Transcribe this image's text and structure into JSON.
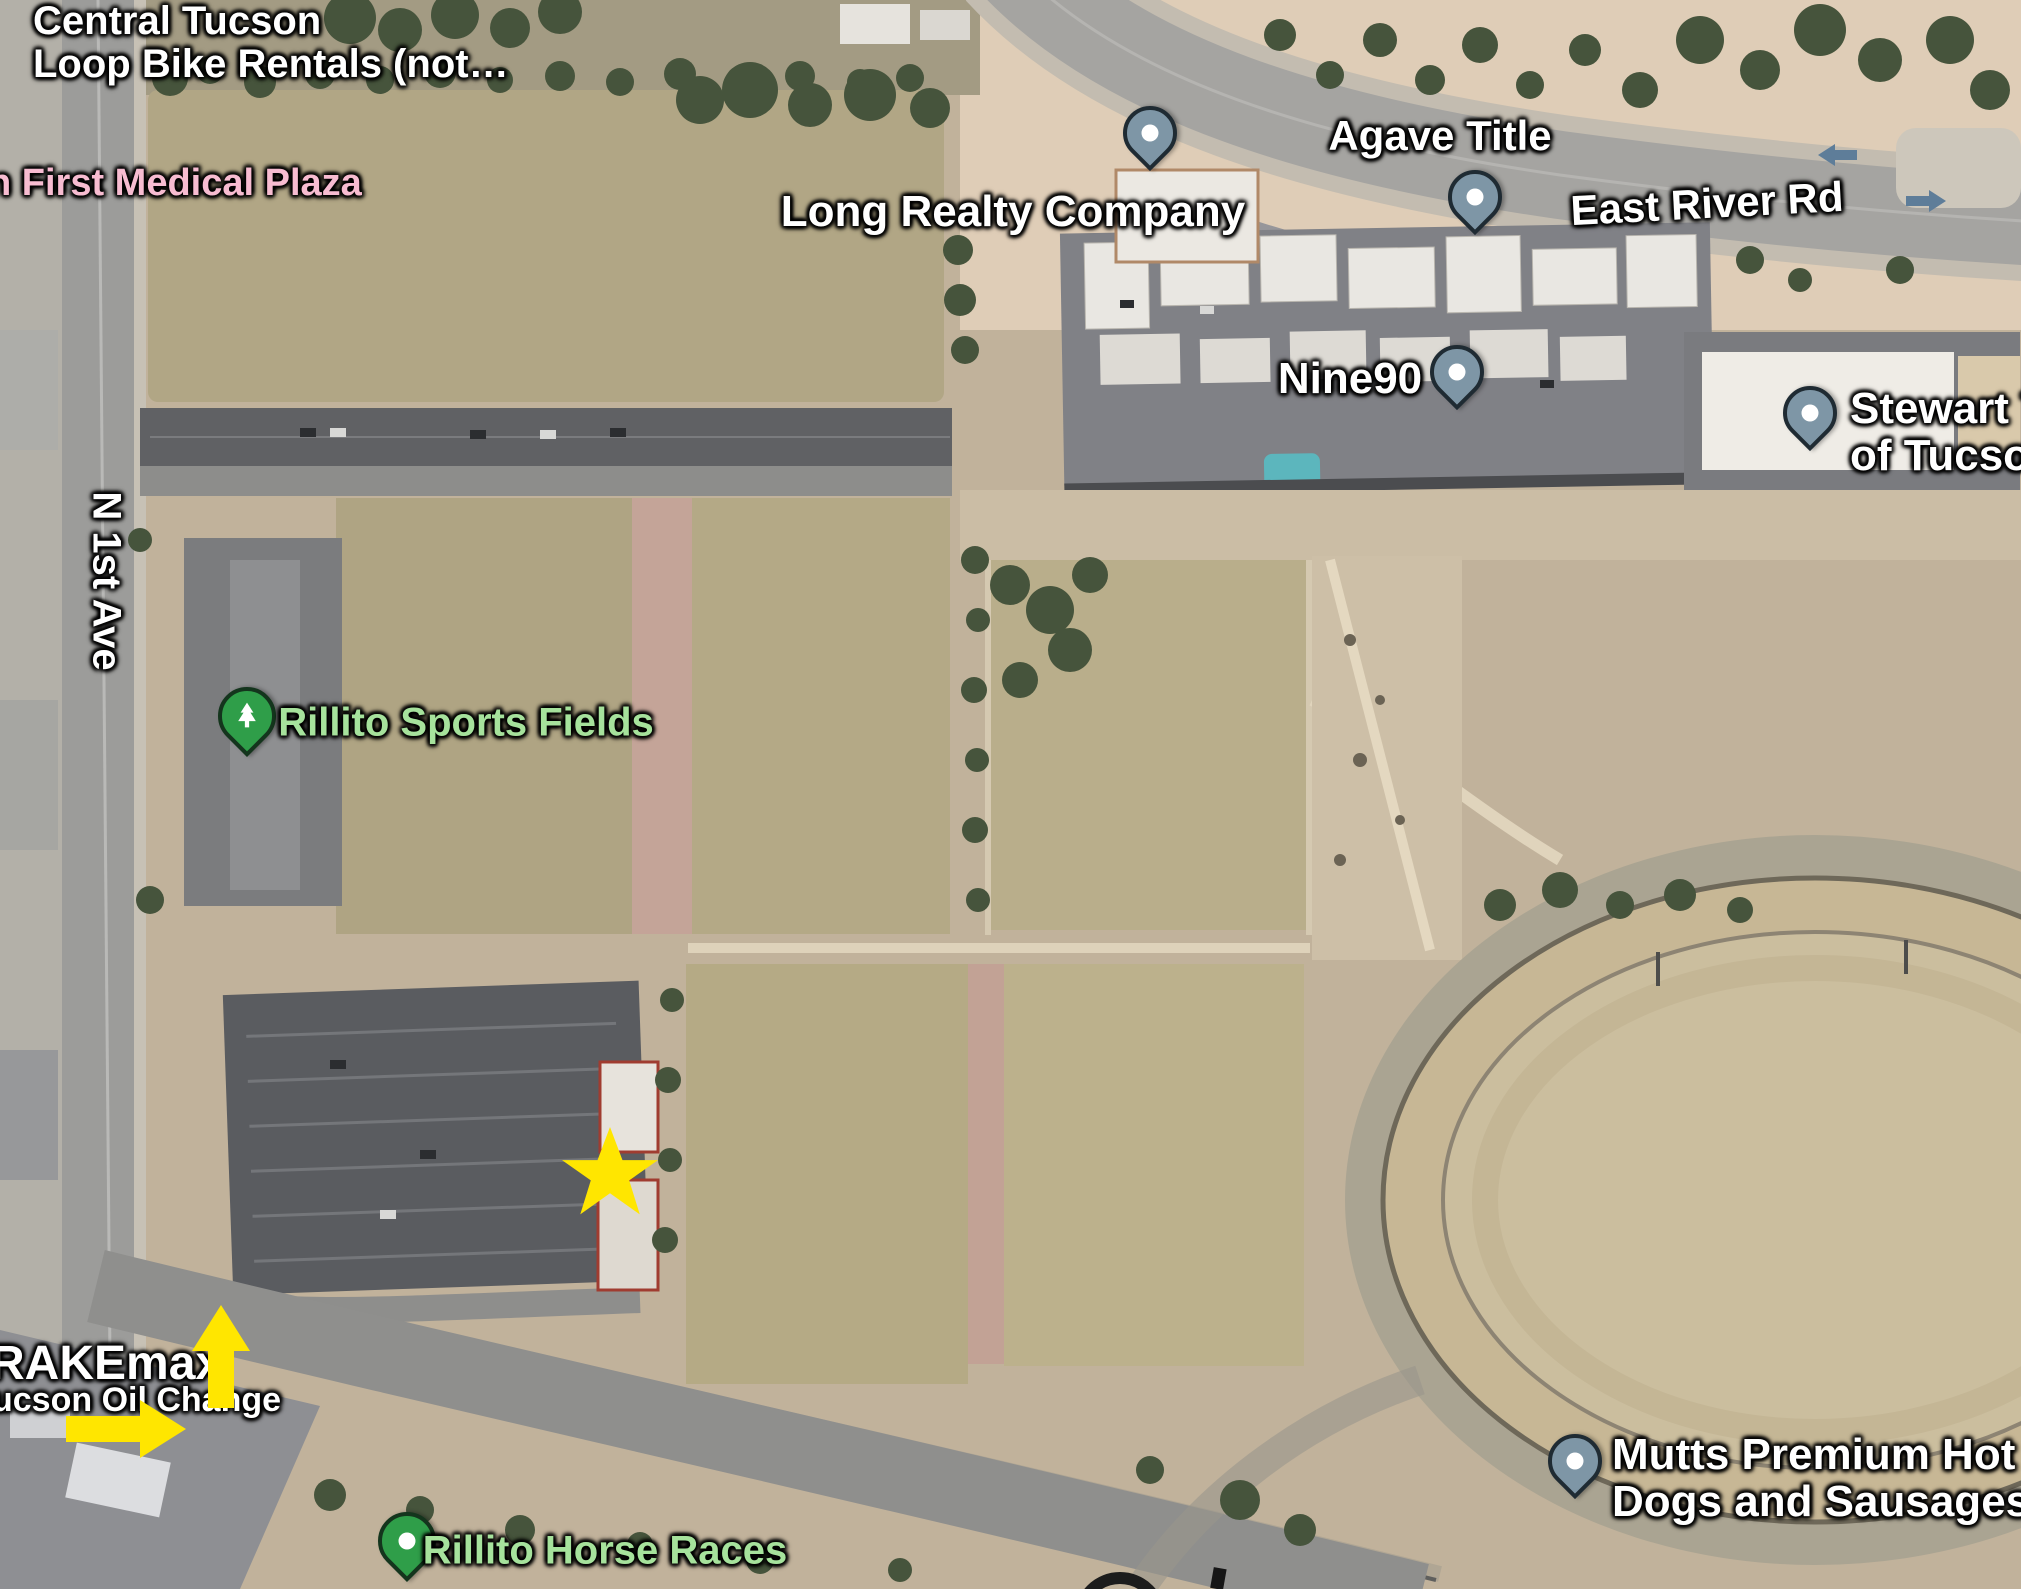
{
  "map": {
    "colors": {
      "poi_label": "#ffffff",
      "medical_pink": "#f7bcd1",
      "park_green": "#a6e29c",
      "pin_business": "#7e96a6",
      "pin_park": "#2f9e49",
      "annotation_yellow": "#ffe600",
      "road_arrow_blue": "#5e7d99"
    },
    "labels": {
      "bike_rentals_line1": "Central Tucson",
      "bike_rentals_line2": "Loop Bike Rentals (not…",
      "medical_plaza": "n First Medical Plaza",
      "long_realty": "Long Realty Company",
      "agave_title": "Agave Title",
      "east_river_rd": "East River Rd",
      "nine90": "Nine90",
      "stewart_line1": "Stewart T",
      "stewart_line2": "of Tucson",
      "sports_fields": "Rillito Sports Fields",
      "n_1st_ave": "N 1st Ave",
      "brakemax": "RAKEmax",
      "oil_change": "ucson Oil Change",
      "horse_races": "Rillito Horse Races",
      "mutts_line1": "Mutts Premium Hot",
      "mutts_line2": "Dogs and Sausages"
    },
    "pins": {
      "long_realty": "business-pin",
      "agave_title": "business-pin",
      "nine90": "business-pin",
      "stewart_title": "business-pin",
      "mutts_hot_dogs": "business-pin",
      "rillito_sports_fields": "park-tree-pin",
      "rillito_horse_races": "park-pin"
    },
    "annotations": {
      "star": "yellow-star-on-parking-lot",
      "arrow_up": "yellow-arrow-pointing-up",
      "arrow_right": "yellow-arrow-pointing-right"
    }
  }
}
